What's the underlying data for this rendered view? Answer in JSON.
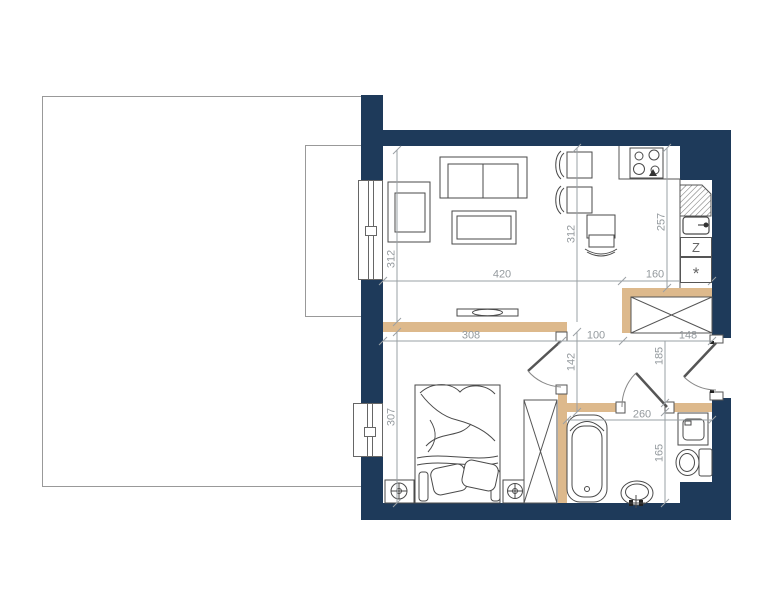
{
  "plan": {
    "dimensions": {
      "living_width": "420",
      "kitchen_width": "160",
      "living_height": "312",
      "dining_height": "312",
      "kitchen_height": "257",
      "bedroom_width": "308",
      "hall_width": "100",
      "closet_width": "148",
      "hall_height_left": "142",
      "hall_height_right": "185",
      "bedroom_height": "307",
      "bathroom_width": "260",
      "bathroom_height": "165"
    },
    "labels": {
      "dishwasher": "Z",
      "fridge": "*"
    },
    "colors": {
      "exterior_wall": "#1e3a5a",
      "partition_wall": "#ddb98c",
      "dimension_line": "#949a9e",
      "furniture_line": "#4a4a4a",
      "terrace_border": "#999999"
    }
  }
}
